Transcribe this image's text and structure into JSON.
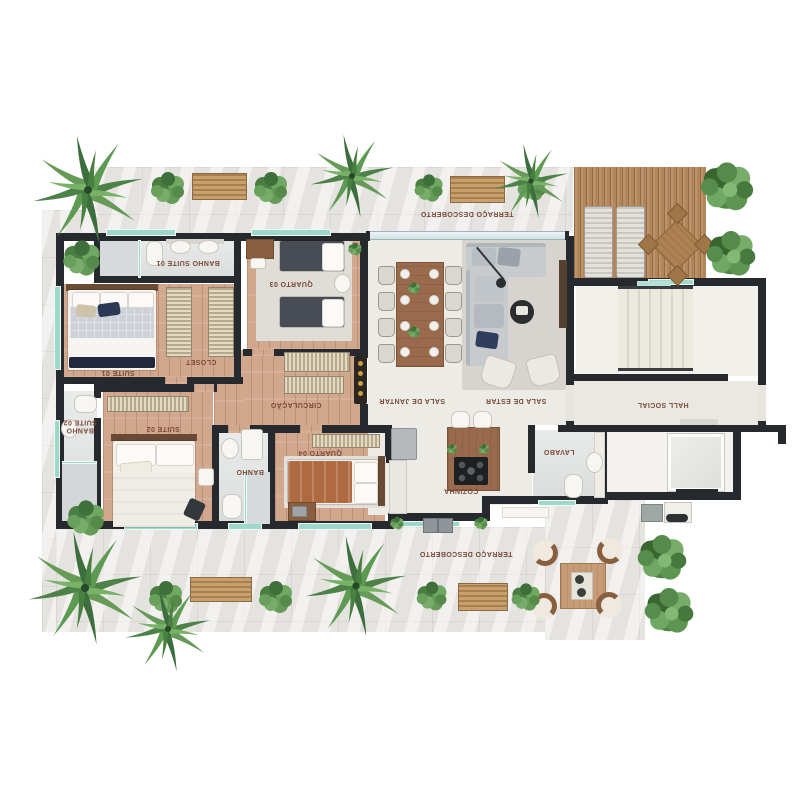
{
  "labels": {
    "terraco_top": "TERRAÇO DESCOBERTO",
    "terraco_bottom": "TERRAÇO DESCOBERTO",
    "banho_suite_01": "BANHO SUITE 01",
    "quarto_03": "QUARTO 03",
    "suite_01": "SUITE 01",
    "closet": "CLOSET",
    "circulacao": "CIRCULAÇÃO",
    "sala_de_jantar": "SALA DE JANTAR",
    "sala_de_estar": "SALA DE ESTAR",
    "hall_social": "HALL SOCIAL",
    "banho_suite_02": "BANHO SUITE 02",
    "suite_02": "SUITE 02",
    "banho": "BANHO",
    "quarto_04": "QUARTO 04",
    "cozinha": "COZINHA",
    "lavabo": "LAVABO"
  },
  "colors": {
    "wall": "#26292d",
    "terrace": "#e5e3e0",
    "deck_wood": "#b3855a",
    "room_wood": "#d1a88e",
    "living_floor": "#edebe5",
    "bath_floor": "#e2e4e4",
    "glass": "#9ed8cb",
    "label_text": "#7a4a38",
    "accent_wood": "#9a6a4c",
    "plant_green": "#558a4b"
  }
}
